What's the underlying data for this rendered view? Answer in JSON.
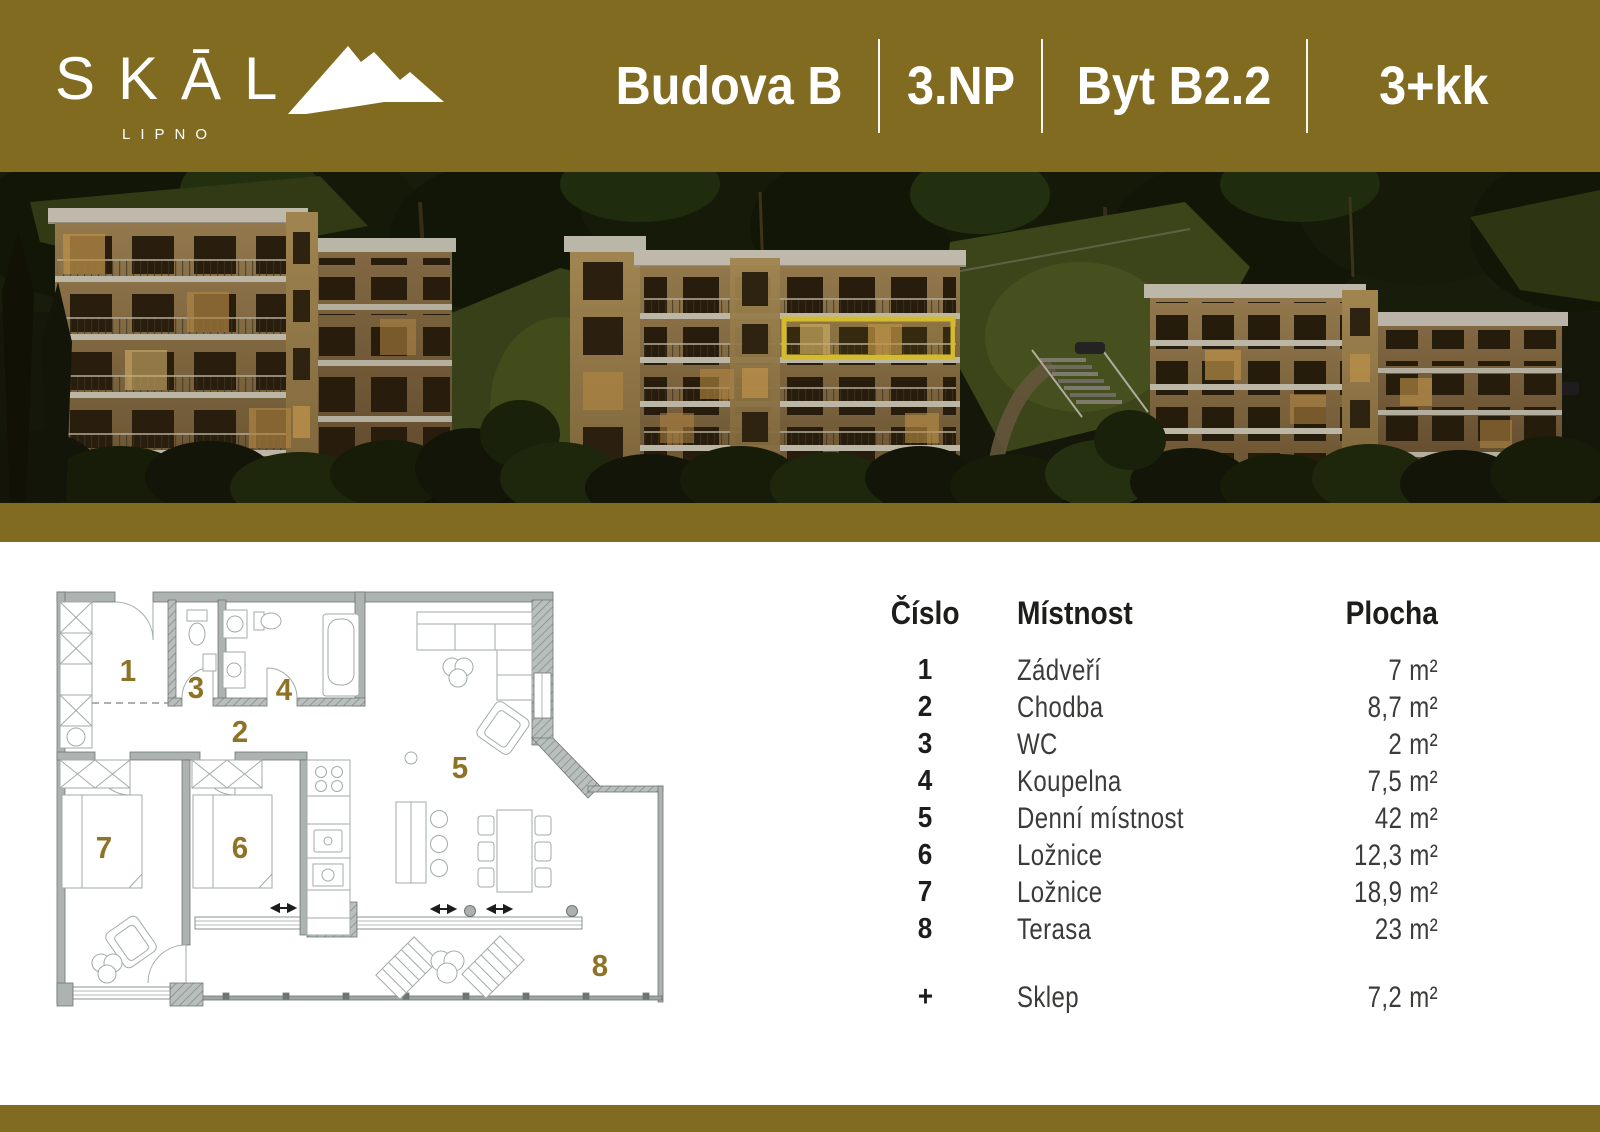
{
  "brand": {
    "wordmark": "SKĀL",
    "subtitle": "LIPNO"
  },
  "header": {
    "building_label": "Budova B",
    "floor_label": "3.NP",
    "unit_label": "Byt B2.2",
    "disposition_label": "3+kk"
  },
  "colors": {
    "accent_gold": "#816B21",
    "plan_number_gold": "#8E7326",
    "highlight_yellow": "#F6DA36"
  },
  "legend": {
    "headers": {
      "number": "Číslo",
      "room": "Místnost",
      "area": "Plocha"
    },
    "rows": [
      {
        "number": "1",
        "room": "Zádveří",
        "area": "7 m²"
      },
      {
        "number": "2",
        "room": "Chodba",
        "area": "8,7 m²"
      },
      {
        "number": "3",
        "room": "WC",
        "area": "2 m²"
      },
      {
        "number": "4",
        "room": "Koupelna",
        "area": "7,5 m²"
      },
      {
        "number": "5",
        "room": "Denní místnost",
        "area": "42 m²"
      },
      {
        "number": "6",
        "room": "Ložnice",
        "area": "12,3 m²"
      },
      {
        "number": "7",
        "room": "Ložnice",
        "area": "18,9 m²"
      },
      {
        "number": "8",
        "room": "Terasa",
        "area": "23 m²"
      }
    ],
    "extra": {
      "number": "+",
      "room": "Sklep",
      "area": "7,2 m²"
    }
  },
  "plan": {
    "labels": [
      "1",
      "2",
      "3",
      "4",
      "5",
      "6",
      "7",
      "8"
    ]
  }
}
